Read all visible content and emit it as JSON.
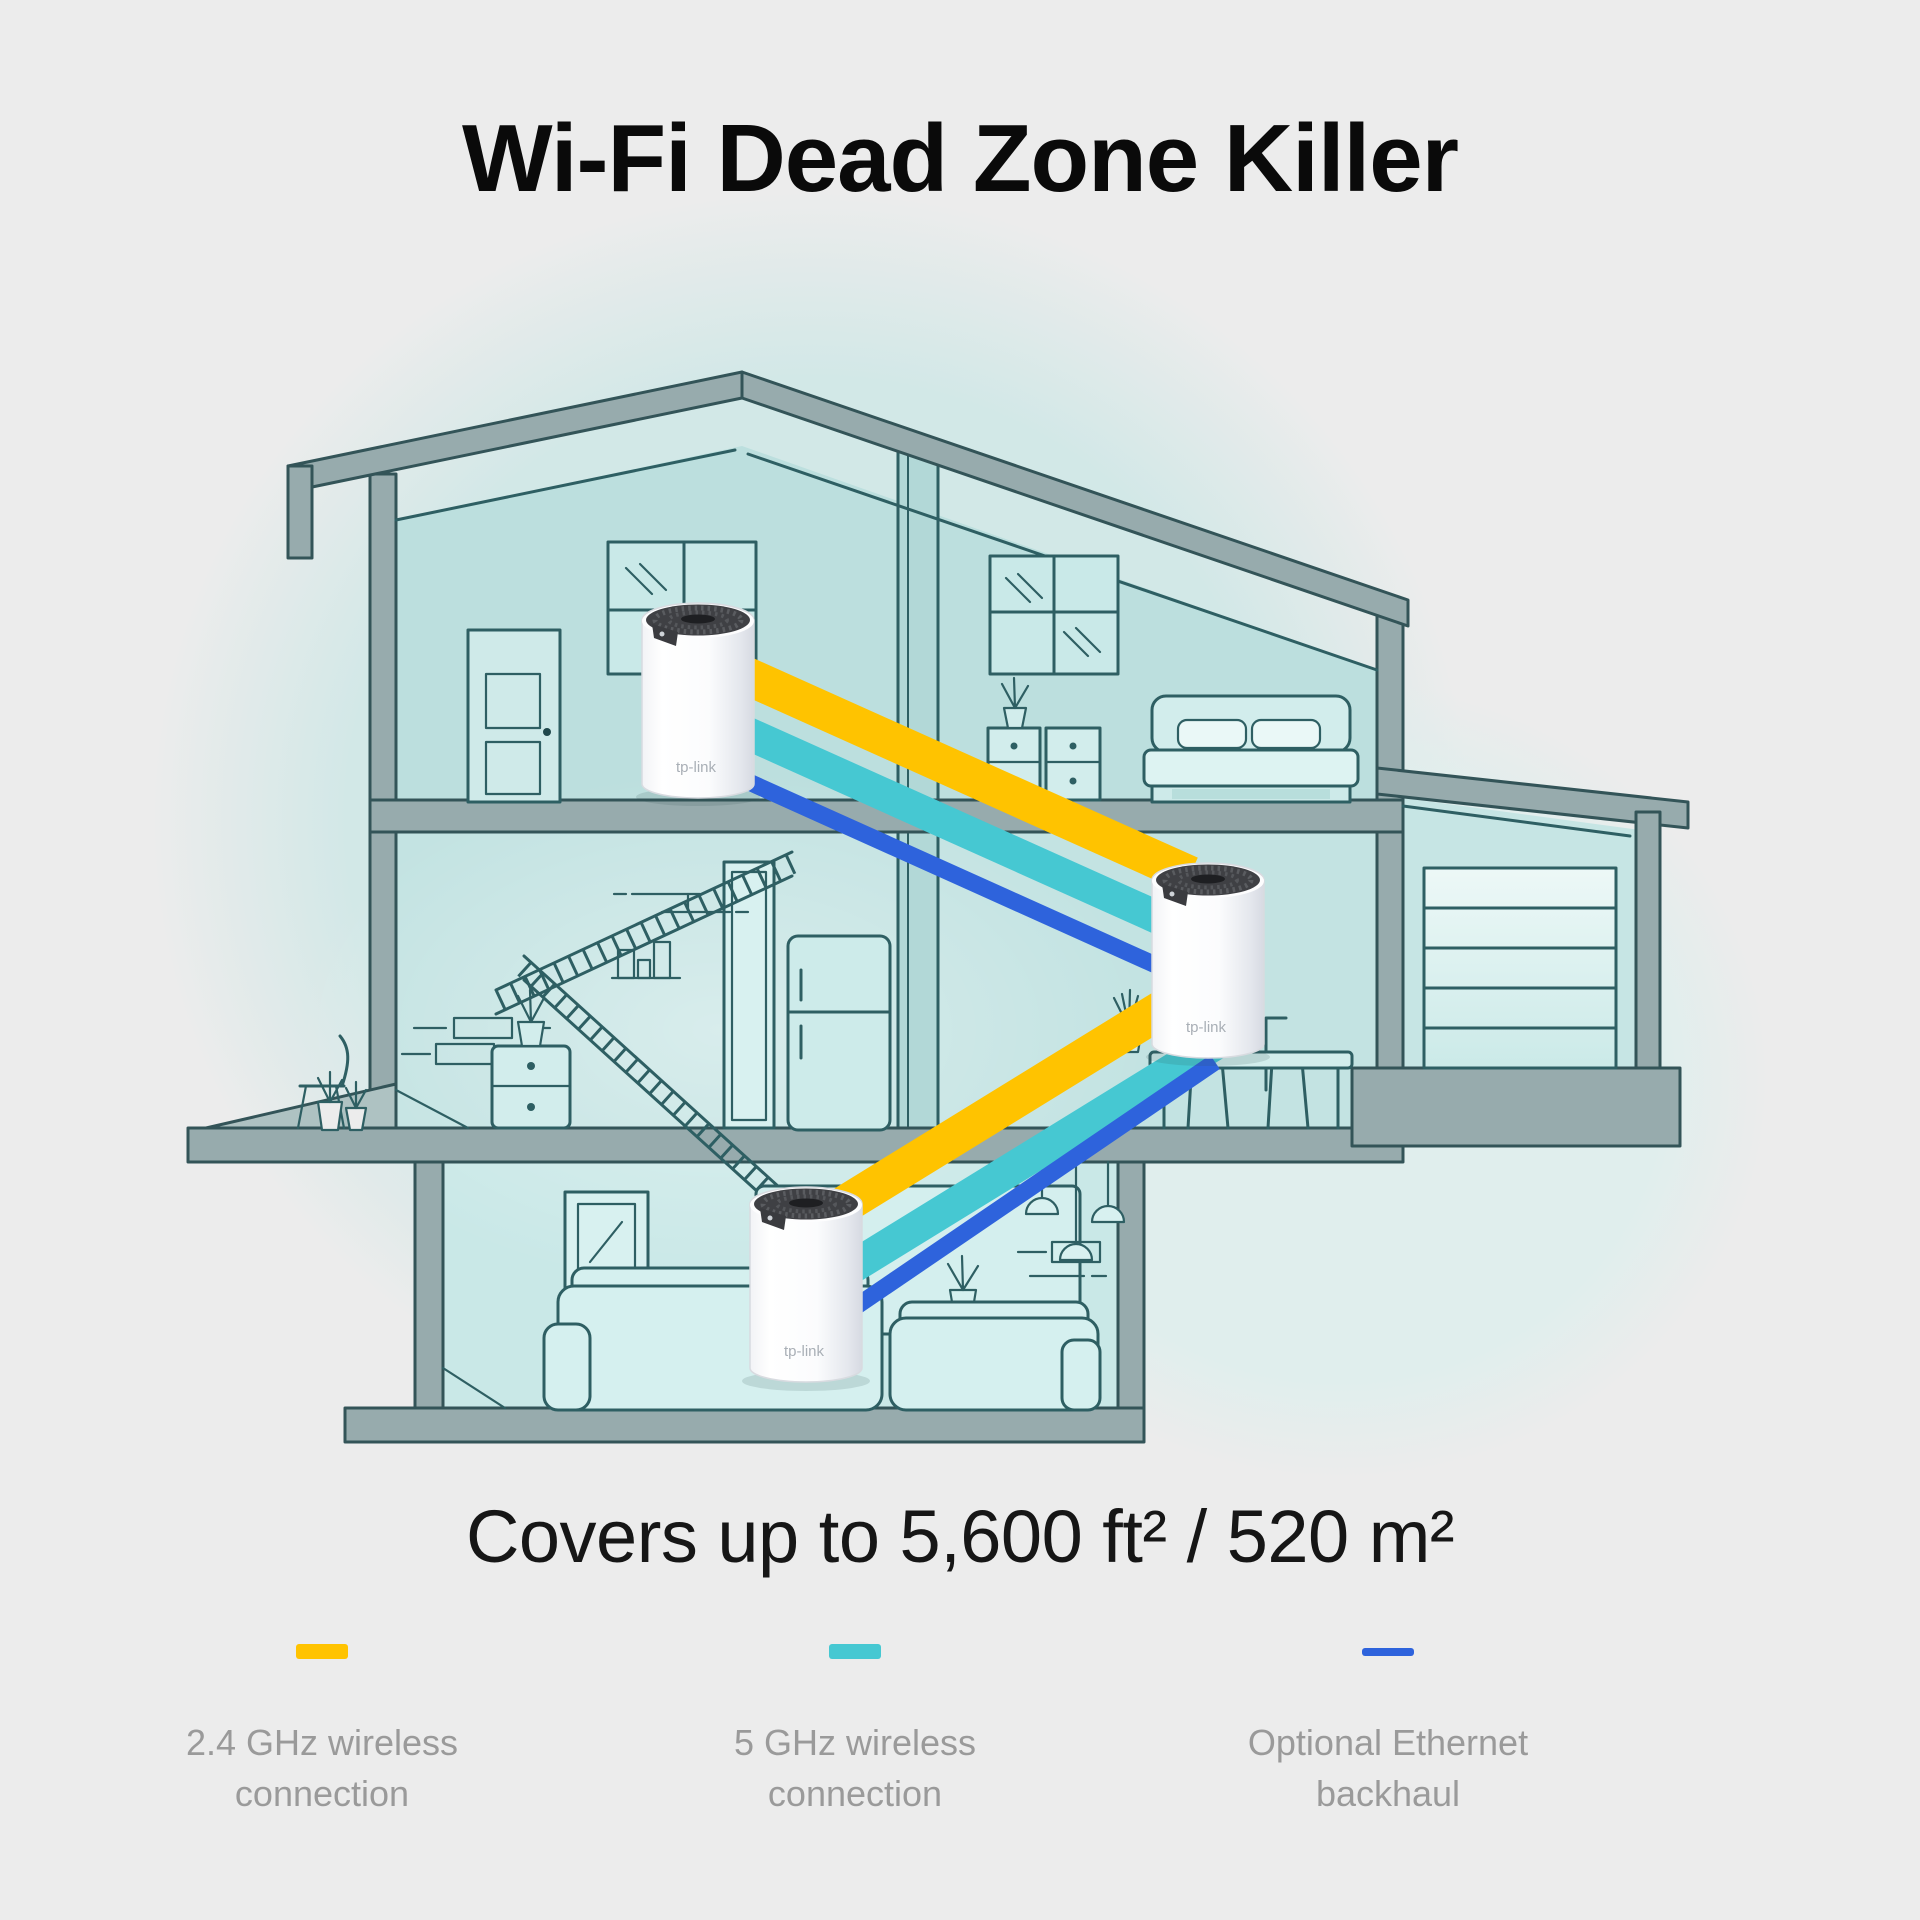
{
  "page": {
    "background_color": "#ECECEC"
  },
  "title": "Wi-Fi Dead Zone Killer",
  "coverage_caption": "Covers up to 5,600 ft² / 520 m²",
  "brand": "tp-link",
  "legend": {
    "items": [
      {
        "id": "wireless-24ghz",
        "color": "#FFC300",
        "swatch": "thick",
        "label_line1": "2.4 GHz wireless",
        "label_line2": "connection"
      },
      {
        "id": "wireless-5ghz",
        "color": "#46C8D2",
        "swatch": "thick",
        "label_line1": "5 GHz wireless",
        "label_line2": "connection"
      },
      {
        "id": "ethernet-backhaul",
        "color": "#2E63DC",
        "swatch": "thin",
        "label_line1": "Optional Ethernet",
        "label_line2": "backhaul"
      }
    ]
  }
}
